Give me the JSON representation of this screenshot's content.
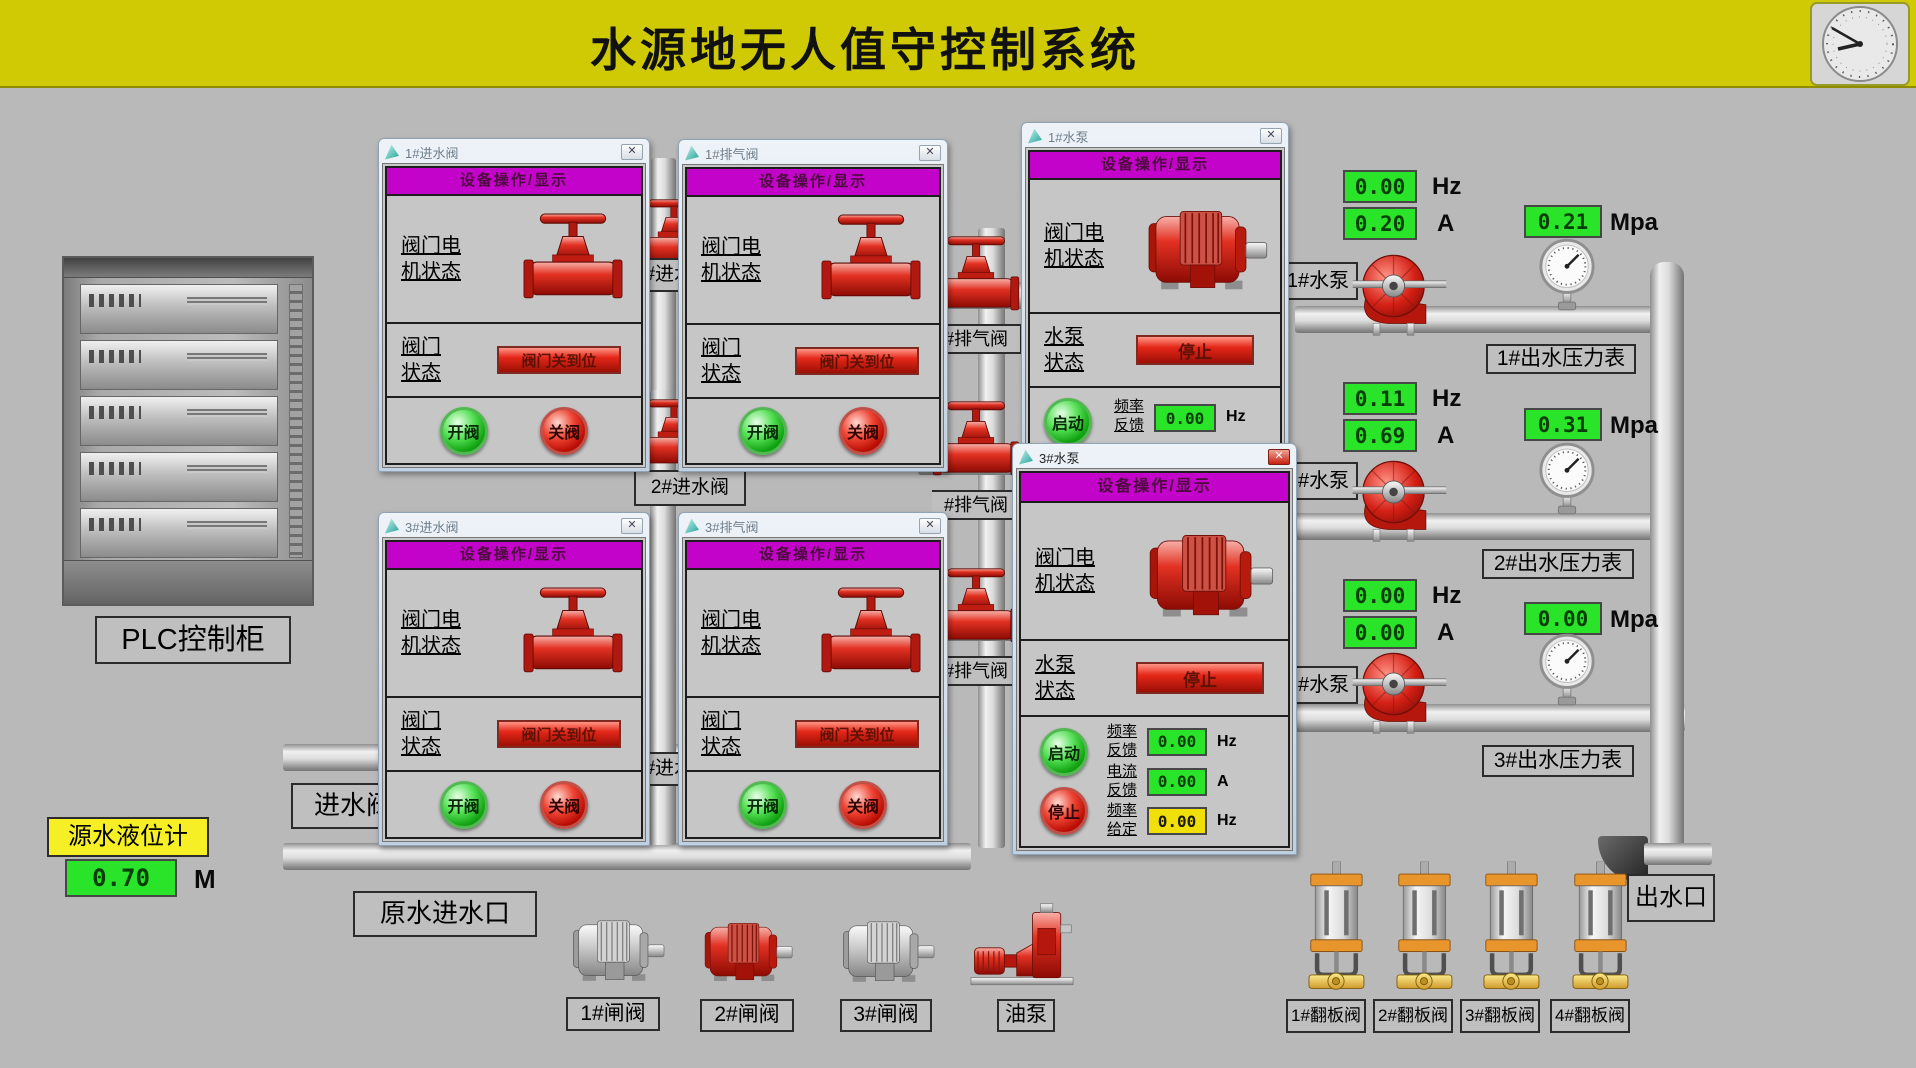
{
  "banner": {
    "title": "水源地无人值守控制系统"
  },
  "chrome": {
    "close_glyph": "✕"
  },
  "plc": {
    "label": "PLC控制柜"
  },
  "level": {
    "label": "源水液位计",
    "value": "0.70",
    "unit": "M"
  },
  "tags": {
    "inlet_valve": "进水阀",
    "raw_inlet": "原水进水口",
    "outlet": "出水口",
    "gap_top": "1#进水阀",
    "inlet2": "2#进水阀",
    "gap_bottom": "3#进水阀",
    "exhaust1": "#排气阀",
    "exhaust2": "#排气阀",
    "exhaust3": "#排气阀",
    "pump1": "1#水泵",
    "pump2": "2#水泵",
    "pump3": "3#水泵"
  },
  "windows": [
    {
      "title": "1#进水阀",
      "header": "设备操作/显示",
      "motor_l1": "阀门电",
      "motor_l2": "机状态",
      "status_l1": "阀门",
      "status_l2": "状态",
      "status": "阀门关到位",
      "open": "开阀",
      "close": "关阀"
    },
    {
      "title": "1#排气阀",
      "header": "设备操作/显示",
      "motor_l1": "阀门电",
      "motor_l2": "机状态",
      "status_l1": "阀门",
      "status_l2": "状态",
      "status": "阀门关到位",
      "open": "开阀",
      "close": "关阀"
    },
    {
      "title": "3#进水阀",
      "header": "设备操作/显示",
      "motor_l1": "阀门电",
      "motor_l2": "机状态",
      "status_l1": "阀门",
      "status_l2": "状态",
      "status": "阀门关到位",
      "open": "开阀",
      "close": "关阀"
    },
    {
      "title": "3#排气阀",
      "header": "设备操作/显示",
      "motor_l1": "阀门电",
      "motor_l2": "机状态",
      "status_l1": "阀门",
      "status_l2": "状态",
      "status": "阀门关到位",
      "open": "开阀",
      "close": "关阀"
    },
    {
      "title": "1#水泵",
      "header": "设备操作/显示",
      "motor_l1": "阀门电",
      "motor_l2": "机状态",
      "pump_l1": "水泵",
      "pump_l2": "状态",
      "pump_status": "停止",
      "start": "启动",
      "freq_l1": "频率",
      "freq_l2": "反馈",
      "freq_value": "0.00",
      "freq_unit": "Hz"
    },
    {
      "title": "3#水泵",
      "header": "设备操作/显示",
      "motor_l1": "阀门电",
      "motor_l2": "机状态",
      "pump_l1": "水泵",
      "pump_l2": "状态",
      "pump_status": "停止",
      "start": "启动",
      "stop": "停止",
      "rows": [
        {
          "l1": "频率",
          "l2": "反馈",
          "v": "0.00",
          "u": "Hz",
          "style": "g"
        },
        {
          "l1": "电流",
          "l2": "反馈",
          "v": "0.00",
          "u": "A",
          "style": "g"
        },
        {
          "l1": "频率",
          "l2": "给定",
          "v": "0.00",
          "u": "Hz",
          "style": "y"
        }
      ]
    }
  ],
  "pump_rows": [
    {
      "freq": "0.00",
      "freq_u": "Hz",
      "amp": "0.20",
      "amp_u": "A",
      "press": "0.21",
      "press_u": "Mpa",
      "gauge_tag": "1#出水压力表"
    },
    {
      "freq": "0.11",
      "freq_u": "Hz",
      "amp": "0.69",
      "amp_u": "A",
      "press": "0.31",
      "press_u": "Mpa",
      "gauge_tag": "2#出水压力表"
    },
    {
      "freq": "0.00",
      "freq_u": "Hz",
      "amp": "0.00",
      "amp_u": "A",
      "press": "0.00",
      "press_u": "Mpa",
      "gauge_tag": "3#出水压力表"
    }
  ],
  "bottom": {
    "devices": [
      {
        "label": "1#闸阀"
      },
      {
        "label": "2#闸阀"
      },
      {
        "label": "3#闸阀"
      },
      {
        "label": "油泵"
      }
    ],
    "flaps": [
      {
        "label": "1#翻板阀"
      },
      {
        "label": "2#翻板阀"
      },
      {
        "label": "3#翻板阀"
      },
      {
        "label": "4#翻板阀"
      }
    ]
  },
  "colors": {
    "banner_yellow": "#cfca04",
    "display_green": "#2ae42a",
    "display_yellow": "#f0df08",
    "header_magenta": "#c303c9",
    "status_red": "#e42718",
    "device_red": "#d42015"
  }
}
